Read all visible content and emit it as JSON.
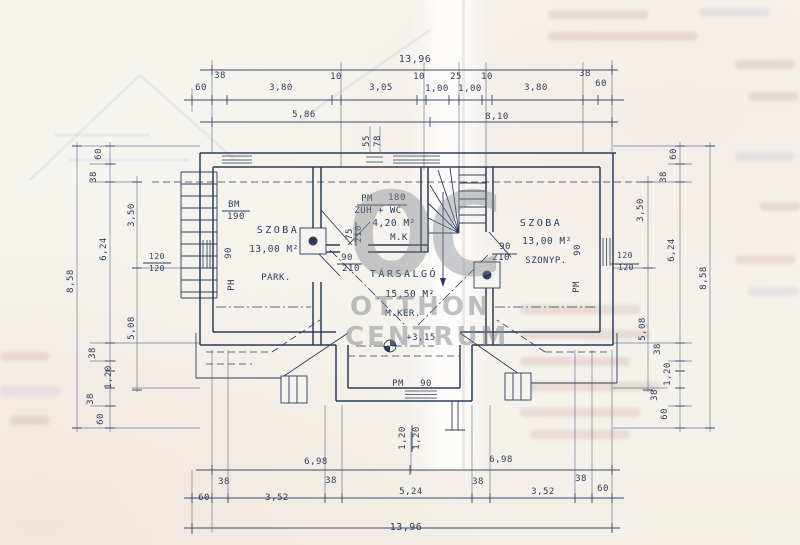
{
  "watermark": {
    "logo": "OC",
    "line1": "OTTHON",
    "line2": "CENTRUM"
  },
  "colors": {
    "ink": "#2d3d5b",
    "paper": "#f6f4ee",
    "watermark_gray": "#80858c"
  },
  "plan_labels": [
    {
      "n": "dim-top-overall",
      "t": "13,96",
      "x": 415,
      "y": 62,
      "s": 10
    },
    {
      "n": "dim-label",
      "t": "60",
      "x": 201,
      "y": 90
    },
    {
      "n": "dim-label",
      "t": "38",
      "x": 220,
      "y": 78
    },
    {
      "n": "dim-label",
      "t": "3,80",
      "x": 281,
      "y": 90
    },
    {
      "n": "dim-label",
      "t": "10",
      "x": 336,
      "y": 79
    },
    {
      "n": "dim-label",
      "t": "3,05",
      "x": 381,
      "y": 90
    },
    {
      "n": "dim-label",
      "t": "10",
      "x": 419,
      "y": 79
    },
    {
      "n": "dim-label",
      "t": "1,00",
      "x": 437,
      "y": 91
    },
    {
      "n": "dim-label",
      "t": "25",
      "x": 456,
      "y": 79
    },
    {
      "n": "dim-label",
      "t": "1,00",
      "x": 470,
      "y": 91
    },
    {
      "n": "dim-label",
      "t": "10",
      "x": 487,
      "y": 79
    },
    {
      "n": "dim-label",
      "t": "3,80",
      "x": 536,
      "y": 90
    },
    {
      "n": "dim-label",
      "t": "38",
      "x": 585,
      "y": 76
    },
    {
      "n": "dim-label",
      "t": "60",
      "x": 601,
      "y": 86
    },
    {
      "n": "dim-label",
      "t": "5,86",
      "x": 304,
      "y": 117
    },
    {
      "n": "dim-label",
      "t": "8,10",
      "x": 497,
      "y": 119
    },
    {
      "n": "dim-label",
      "t": "55",
      "x": 369,
      "y": 141,
      "r": -90
    },
    {
      "n": "dim-label",
      "t": "78",
      "x": 380,
      "y": 141,
      "r": -90
    },
    {
      "n": "dim-left-overall",
      "t": "8,58",
      "x": 73,
      "y": 281,
      "r": -90
    },
    {
      "n": "dim-label",
      "t": "60",
      "x": 101,
      "y": 154,
      "r": -90
    },
    {
      "n": "dim-label",
      "t": "38",
      "x": 96,
      "y": 177,
      "r": -90
    },
    {
      "n": "dim-label",
      "t": "3,50",
      "x": 134,
      "y": 215,
      "r": -90
    },
    {
      "n": "dim-label",
      "t": "6,24",
      "x": 106,
      "y": 249,
      "r": -90
    },
    {
      "n": "dim-label",
      "t": "120",
      "x": 157,
      "y": 259,
      "s": 8
    },
    {
      "n": "dim-label",
      "t": "120",
      "x": 157,
      "y": 271,
      "s": 8
    },
    {
      "n": "dim-label",
      "t": "5,08",
      "x": 134,
      "y": 328,
      "r": -90
    },
    {
      "n": "dim-label",
      "t": "38",
      "x": 95,
      "y": 353,
      "r": -90
    },
    {
      "n": "dim-label",
      "t": "1,20",
      "x": 111,
      "y": 377,
      "r": -90
    },
    {
      "n": "dim-label",
      "t": "38",
      "x": 93,
      "y": 399,
      "r": -90
    },
    {
      "n": "dim-label",
      "t": "60",
      "x": 103,
      "y": 419,
      "r": -90
    },
    {
      "n": "dim-right-overall",
      "t": "8,58",
      "x": 706,
      "y": 278,
      "r": -90
    },
    {
      "n": "dim-label",
      "t": "60",
      "x": 676,
      "y": 154,
      "r": -90
    },
    {
      "n": "dim-label",
      "t": "38",
      "x": 666,
      "y": 177,
      "r": -90
    },
    {
      "n": "dim-label",
      "t": "3,50",
      "x": 643,
      "y": 210,
      "r": -90
    },
    {
      "n": "dim-label",
      "t": "6,24",
      "x": 674,
      "y": 250,
      "r": -90
    },
    {
      "n": "dim-label",
      "t": "120",
      "x": 625,
      "y": 258,
      "s": 8
    },
    {
      "n": "dim-label",
      "t": "120",
      "x": 626,
      "y": 270,
      "s": 8
    },
    {
      "n": "dim-label",
      "t": "5,08",
      "x": 645,
      "y": 329,
      "r": -90
    },
    {
      "n": "dim-label",
      "t": "38",
      "x": 660,
      "y": 349,
      "r": -90
    },
    {
      "n": "dim-label",
      "t": "1,20",
      "x": 670,
      "y": 374,
      "r": -90
    },
    {
      "n": "dim-label",
      "t": "38",
      "x": 657,
      "y": 395,
      "r": -90
    },
    {
      "n": "dim-label",
      "t": "60",
      "x": 667,
      "y": 414,
      "r": -90
    },
    {
      "n": "dim-label",
      "t": "6,98",
      "x": 316,
      "y": 464
    },
    {
      "n": "dim-label",
      "t": "6,98",
      "x": 501,
      "y": 462
    },
    {
      "n": "dim-label",
      "t": "38",
      "x": 224,
      "y": 484
    },
    {
      "n": "dim-label",
      "t": "60",
      "x": 204,
      "y": 500
    },
    {
      "n": "dim-label",
      "t": "3,52",
      "x": 277,
      "y": 500
    },
    {
      "n": "dim-label",
      "t": "38",
      "x": 331,
      "y": 483
    },
    {
      "n": "dim-label",
      "t": "5,24",
      "x": 411,
      "y": 494
    },
    {
      "n": "dim-label",
      "t": "38",
      "x": 478,
      "y": 484
    },
    {
      "n": "dim-label",
      "t": "3,52",
      "x": 543,
      "y": 494
    },
    {
      "n": "dim-label",
      "t": "38",
      "x": 581,
      "y": 481
    },
    {
      "n": "dim-label",
      "t": "60",
      "x": 603,
      "y": 491
    },
    {
      "n": "dim-bottom-overall",
      "t": "13,96",
      "x": 406,
      "y": 530,
      "s": 10
    },
    {
      "n": "dim-label",
      "t": "1,20",
      "x": 405,
      "y": 438,
      "r": -90
    },
    {
      "n": "dim-label",
      "t": "1,20",
      "x": 419,
      "y": 438,
      "r": -90
    },
    {
      "n": "window-code",
      "t": "BM",
      "x": 234,
      "y": 207
    },
    {
      "n": "window-size",
      "t": "190",
      "x": 236,
      "y": 219
    },
    {
      "n": "room-left-name",
      "t": "SZOBA",
      "x": 278,
      "y": 233,
      "s": 10,
      "ls": 2.5
    },
    {
      "n": "room-left-area",
      "t": "13,00 M²",
      "x": 274,
      "y": 252,
      "s": 9.5
    },
    {
      "n": "room-left-floor",
      "t": "PARK.",
      "x": 276,
      "y": 280
    },
    {
      "n": "dim-label",
      "t": "90",
      "x": 231,
      "y": 253,
      "r": -90
    },
    {
      "n": "window-code",
      "t": "PH",
      "x": 234,
      "y": 285,
      "r": -90
    },
    {
      "n": "window-code",
      "t": "PM",
      "x": 367,
      "y": 201
    },
    {
      "n": "window-size",
      "t": "180",
      "x": 397,
      "y": 200
    },
    {
      "n": "room-bath-name",
      "t": "ZUH + WC",
      "x": 378,
      "y": 213
    },
    {
      "n": "room-bath-area",
      "t": "4,20 M²",
      "x": 394,
      "y": 226,
      "s": 9.5
    },
    {
      "n": "room-bath-floor",
      "t": "M.K",
      "x": 399,
      "y": 240
    },
    {
      "n": "door-size",
      "t": "75",
      "x": 352,
      "y": 234,
      "r": -90
    },
    {
      "n": "door-size",
      "t": "210",
      "x": 361,
      "y": 234,
      "r": -90
    },
    {
      "n": "door-size",
      "t": "90",
      "x": 347,
      "y": 260
    },
    {
      "n": "door-size",
      "t": "210",
      "x": 351,
      "y": 271
    },
    {
      "n": "room-lounge-name",
      "t": "TÁRSALGÓ",
      "x": 404,
      "y": 277,
      "s": 10,
      "ls": 2.5
    },
    {
      "n": "room-lounge-area",
      "t": "15,50 M²",
      "x": 410,
      "y": 297,
      "s": 9.5
    },
    {
      "n": "room-lounge-floor",
      "t": "M.KER.",
      "x": 403,
      "y": 316
    },
    {
      "n": "level-mark",
      "t": "+3,15",
      "x": 421,
      "y": 340
    },
    {
      "n": "room-right-name",
      "t": "SZOBA",
      "x": 541,
      "y": 226,
      "s": 10,
      "ls": 2.5
    },
    {
      "n": "room-right-area",
      "t": "13,00 M²",
      "x": 547,
      "y": 244,
      "s": 9.5
    },
    {
      "n": "room-right-floor",
      "t": "SZONYP.",
      "x": 546,
      "y": 263
    },
    {
      "n": "door-size",
      "t": "90",
      "x": 505,
      "y": 249
    },
    {
      "n": "door-size",
      "t": "210",
      "x": 501,
      "y": 260
    },
    {
      "n": "dim-label",
      "t": "90",
      "x": 580,
      "y": 250,
      "r": -90
    },
    {
      "n": "window-code",
      "t": "PM",
      "x": 579,
      "y": 287,
      "r": -90
    },
    {
      "n": "window-code",
      "t": "PM",
      "x": 398,
      "y": 386
    },
    {
      "n": "window-size",
      "t": "90",
      "x": 426,
      "y": 386
    }
  ]
}
